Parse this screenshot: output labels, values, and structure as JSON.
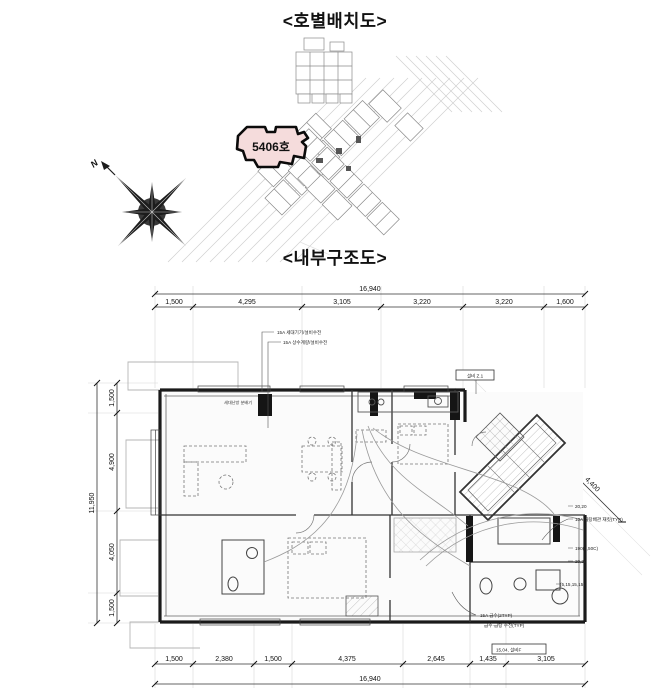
{
  "page": {
    "bg": "#ffffff",
    "ink": "#1a1a1a"
  },
  "site_plan": {
    "title": "<호별배치도>",
    "unit_callout": {
      "label": "5406호",
      "fill": "#f5dcdc"
    },
    "compass": {
      "label": "N"
    }
  },
  "floor_plan": {
    "title": "<내부구조도>",
    "dims": {
      "top_total": "16,940",
      "top_segments": [
        "1,500",
        "4,295",
        "3,105",
        "3,220",
        "3,220",
        "1,600"
      ],
      "left_total": "11,950",
      "left_segments": [
        "1,500",
        "4,900",
        "4,050",
        "1,500"
      ],
      "bottom_total": "16,940",
      "bottom_segments": [
        "1,500",
        "2,380",
        "1,500",
        "4,375",
        "2,645",
        "1,435",
        "3,105"
      ],
      "diagonal": "4,400"
    },
    "annotations": [
      {
        "text": "15A 세대기기/설비수전"
      },
      {
        "text": "15A 상수계량/설비수전"
      },
      {
        "text": "세대난방 분배기"
      },
      {
        "text": "설비 Z.1"
      },
      {
        "text": "20,20"
      },
      {
        "text": "10A 급탕배관 재킷(TYP)"
      },
      {
        "text": "190(2,50C)"
      },
      {
        "text": "20,20"
      },
      {
        "text": "(5,15,15,15)"
      },
      {
        "text": "15A 급수(2TYP)"
      },
      {
        "text": "급수·급탕 수전(TYP)"
      },
      {
        "text": "15,04, 설비F"
      }
    ]
  }
}
